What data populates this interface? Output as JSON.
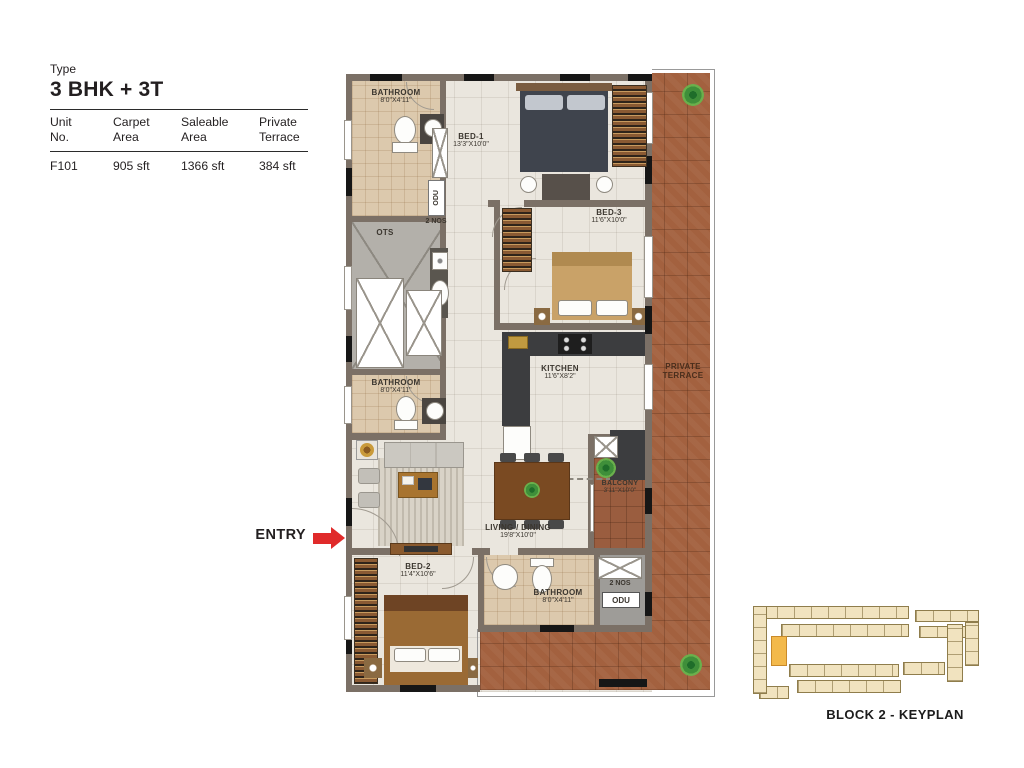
{
  "info": {
    "type_label": "Type",
    "type_value": "3 BHK + 3T",
    "table": {
      "headers": [
        "Unit\nNo.",
        "Carpet\nArea",
        "Saleable\nArea",
        "Private\nTerrace"
      ],
      "row": [
        "F101",
        "905 sft",
        "1366 sft",
        "384 sft"
      ]
    }
  },
  "plan": {
    "entry_label": "ENTRY",
    "rooms": {
      "bathroom_top": {
        "name": "BATHROOM",
        "dims": "8'0\"X4'11\""
      },
      "bed1": {
        "name": "BED-1",
        "dims": "13'3\"X10'0\""
      },
      "bed3": {
        "name": "BED-3",
        "dims": "11'6\"X10'0\""
      },
      "kitchen": {
        "name": "KITCHEN",
        "dims": "11'6\"X8'2\""
      },
      "bathroom_mid": {
        "name": "BATHROOM",
        "dims": "8'0\"X4'11\""
      },
      "living_dining": {
        "name": "LIVING / DINING",
        "dims": "19'8\"X10'0\""
      },
      "balcony": {
        "name": "BALCONY",
        "dims": "3'11\"X10'0\""
      },
      "bed2": {
        "name": "BED-2",
        "dims": "11'4\"X10'6\""
      },
      "bathroom_bottom": {
        "name": "BATHROOM",
        "dims": "8'0\"X4'11\""
      },
      "private_terrace": {
        "name": "PRIVATE\nTERRACE"
      },
      "ots": {
        "name": "OTS"
      }
    },
    "odu_top": {
      "qty": "2 NOS",
      "unit": "ODU"
    },
    "odu_bottom": {
      "qty": "2 NOS",
      "unit": "ODU"
    }
  },
  "keyplan": {
    "caption": "BLOCK 2 - KEYPLAN"
  },
  "colors": {
    "entry_arrow": "#e02a2a",
    "terrace": "#a3613f",
    "keyplan_highlight": "#f3b94b"
  }
}
